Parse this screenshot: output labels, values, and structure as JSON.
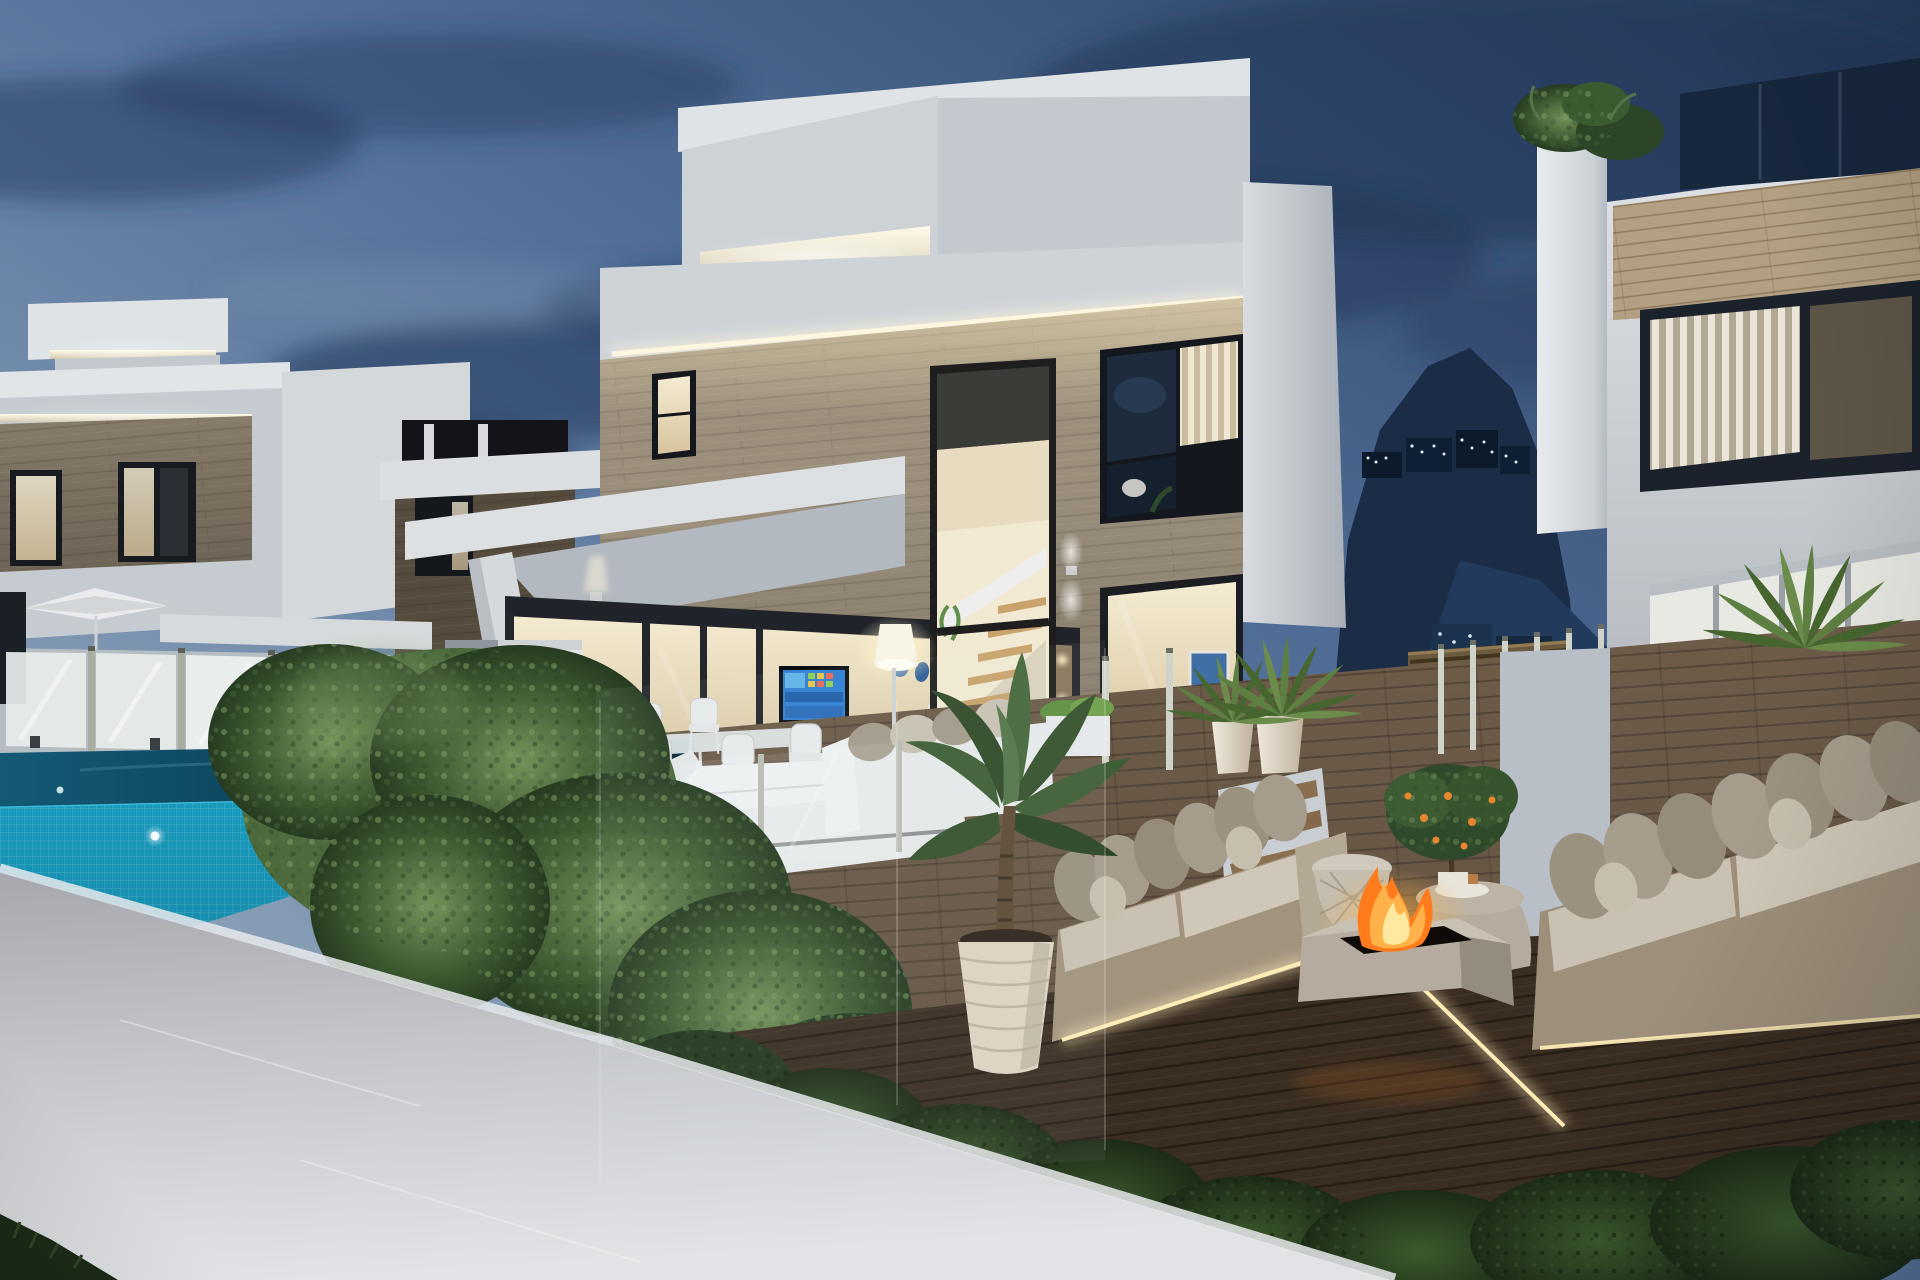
{
  "meta": {
    "title": "New-build luxury villas with infinity pool and fire-pit lounge at dusk",
    "description": "3D architectural exterior visualization, evening scene, no visible text",
    "image_text": "none"
  },
  "palette": {
    "sky_top": "#273c5e",
    "sky_mid": "#54719b",
    "sky_horizon": "#a3b3c3",
    "cloud": "#243a5e",
    "mountain": "#1a2c46",
    "building_shadow": "#0c1a2c",
    "window_light_dot": "#dce6f0",
    "white_lit": "#e8eaec",
    "white_dusk": "#cdd2d7",
    "white_band": "#ced3d8",
    "white_shade": "#aeb4bb",
    "stone": "#9b8f7c",
    "stone_dark": "#56493b",
    "oak": "#b3a083",
    "led_warm": "#fdf6e0",
    "interior_warm": "#f0e5c8",
    "frame_dark": "#20242a",
    "glass_dark": "#17273c",
    "tv_blue": "#2f7fd4",
    "pool_tile": "#1a9ec2",
    "waterline": "#3db9d8",
    "water_deep": "#0a2c44",
    "deck_wood": "#6e5c49",
    "lounge_floor": "#3a2d21",
    "soil": "#54402c",
    "hedge_green": "#4c6a3c",
    "shrub_dark": "#24371e",
    "palm_green": "#5e7f42",
    "sofa_beige": "#c9c2b2",
    "pillow_gray": "#a39a89",
    "daybed_white": "#e6e9ea",
    "pot_cream": "#ddd3c2",
    "concrete": "#b5ac9f",
    "flame": "#ff7b1c",
    "flame_core": "#ffe9a0",
    "orange_fruit": "#e8872e",
    "parasol_white": "#e9ebec",
    "fence_glass": "#e8edeb",
    "post_metal": "#aab0a0"
  },
  "scene": {
    "setting": "dusk",
    "style": "modern two-storey villas",
    "elements": [
      "dusk sky with streaked clouds",
      "hillside with lit apartment buildings",
      "left neighbouring villa with LED cove lighting",
      "main villa with stone-clad facade and LED coves",
      "double-height staircase window",
      "covered outdoor dining terrace",
      "wall-mounted TV with blue smart screen",
      "white outdoor dining chairs and table",
      "glowing floor lamp",
      "infinity pool with turquoise mosaic tiles",
      "underwater pool lights",
      "glass pool fence",
      "white parasol",
      "poolside white daybeds and outdoor sofa",
      "boxwood hedge",
      "white perimeter wall",
      "sunken lounge wooden deck",
      "two beige outdoor sofas with cushions",
      "square concrete fire pit with flames",
      "wicker side table and concrete coffee table",
      "potted orange tree",
      "large potted plant in ribbed white pot",
      "potted palms",
      "wooden steps with glass balustrade",
      "slatted pergola",
      "planting bed with dark shrubs",
      "right neighbouring villa with oak cladding"
    ]
  }
}
